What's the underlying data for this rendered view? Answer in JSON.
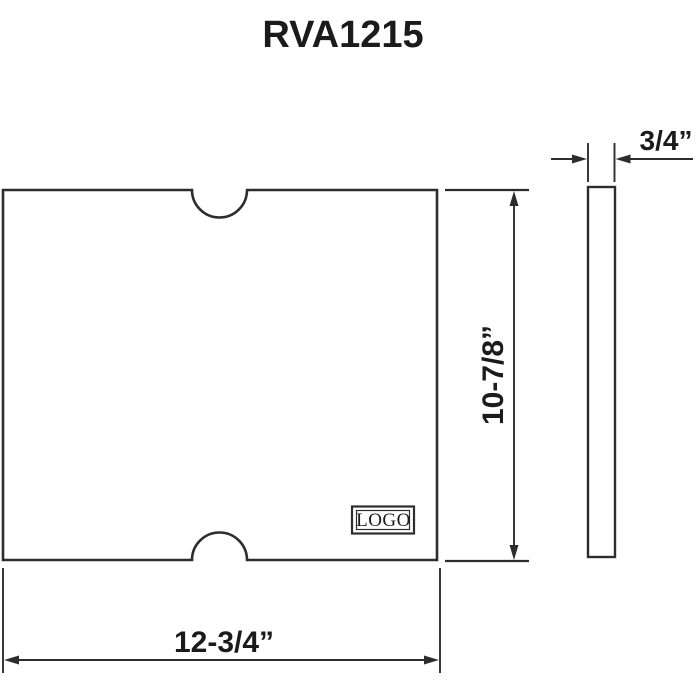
{
  "title": "RVA1215",
  "front_view": {
    "name": "board front view with two semicircular finger notches",
    "logo_text": "LOGO"
  },
  "side_view": {
    "name": "board edge (thickness) view"
  },
  "dimensions": {
    "width": "12-3/4”",
    "height": "10-7/8”",
    "thickness": "3/4”"
  },
  "colors": {
    "line": "#2d2d2d",
    "text": "#1b1b1b",
    "background": "#ffffff"
  }
}
